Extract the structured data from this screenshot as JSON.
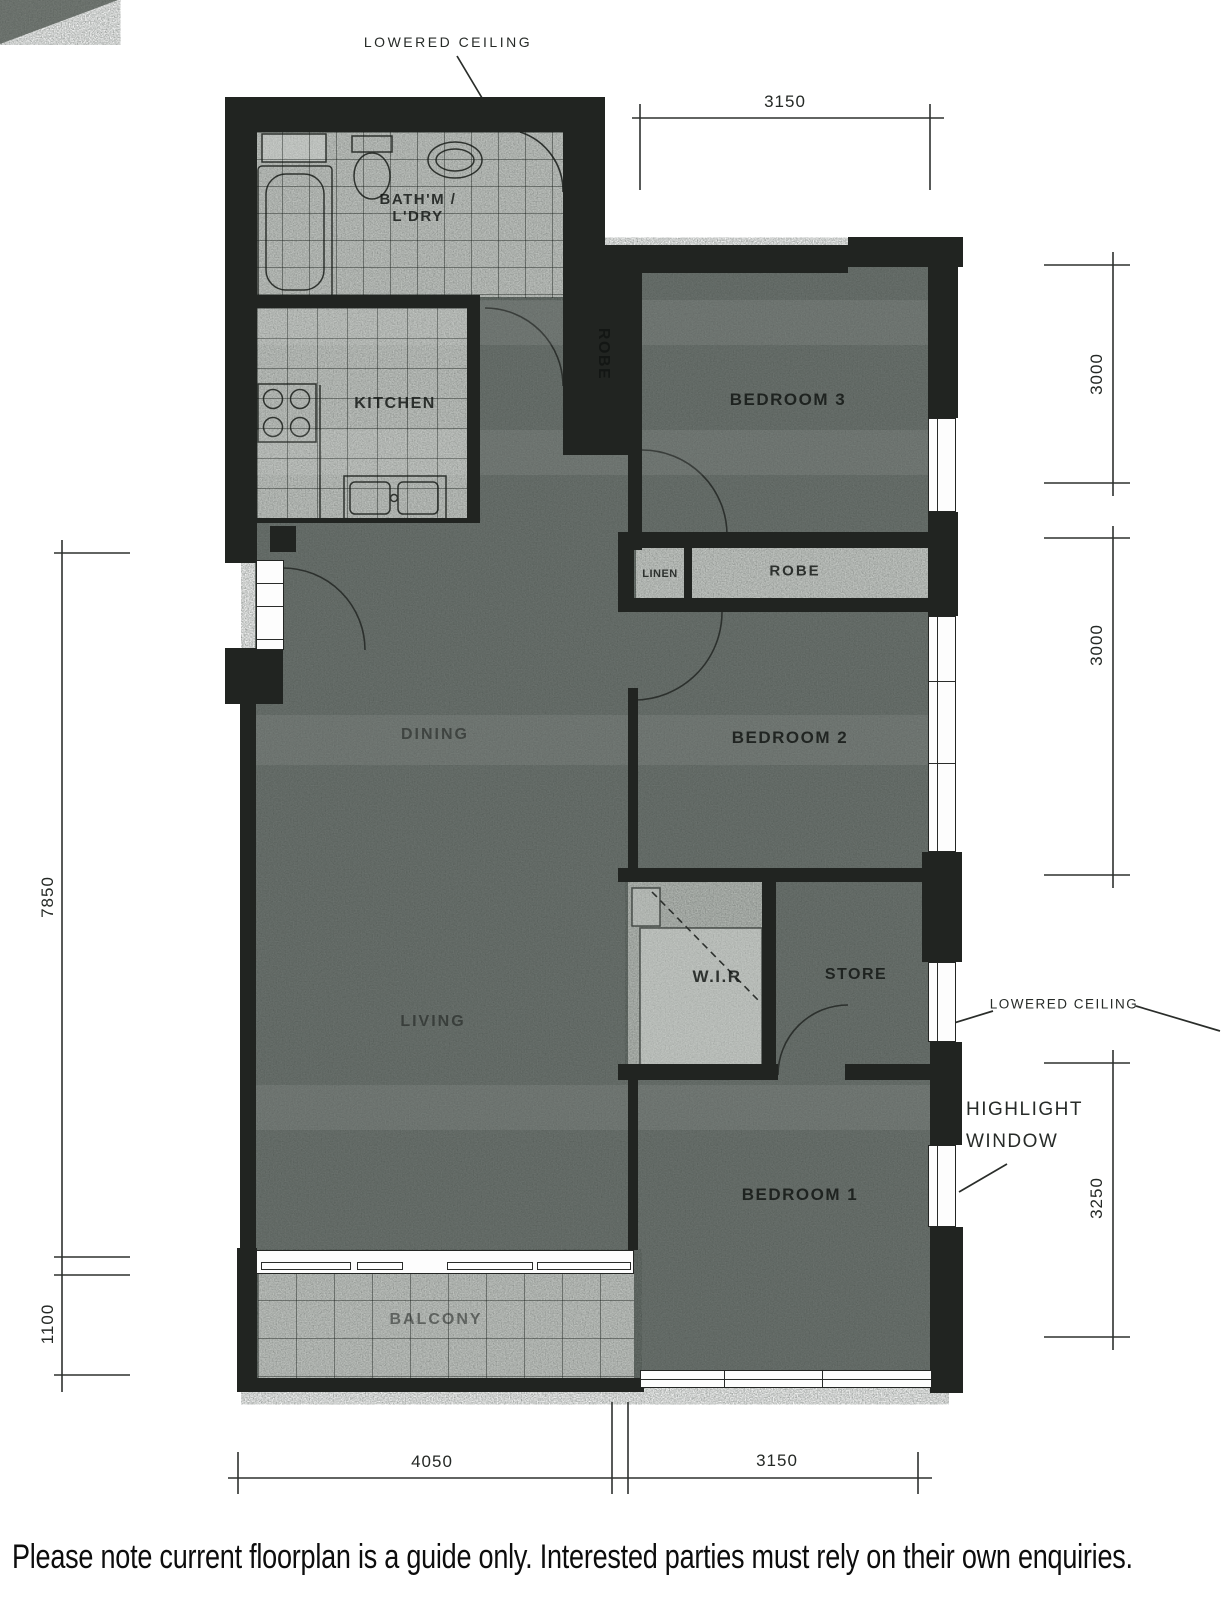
{
  "annotations": {
    "lowered_ceiling_top": "LOWERED CEILING",
    "lowered_ceiling_right": "LOWERED CEILING",
    "highlight_window_line1": "HIGHLIGHT",
    "highlight_window_line2": "WINDOW"
  },
  "rooms": {
    "bath": {
      "line1": "BATH'M /",
      "line2": "L'DRY"
    },
    "kitchen": "KITCHEN",
    "robe_vertical": "ROBE",
    "bedroom3": "BEDROOM 3",
    "linen": "LINEN",
    "robe_horizontal": "ROBE",
    "bedroom2": "BEDROOM 2",
    "dining": "DINING",
    "wir": "W.I.R",
    "store": "STORE",
    "living": "LIVING",
    "bedroom1": "BEDROOM 1",
    "balcony": "BALCONY"
  },
  "dimensions": {
    "top_width": "3150",
    "right_bed3": "3000",
    "right_bed2": "3000",
    "right_bed1": "3250",
    "left_main": "7850",
    "left_balcony": "1100",
    "bottom_left": "4050",
    "bottom_right": "3150"
  },
  "footer": {
    "disclaimer": "Please note current floorplan is a guide only. Interested parties must rely on their own enquiries."
  },
  "colors": {
    "wall": "#212421",
    "room_dark": "#6b726e",
    "room_light": "#c2c6c2",
    "dim_line": "#2e312f"
  }
}
